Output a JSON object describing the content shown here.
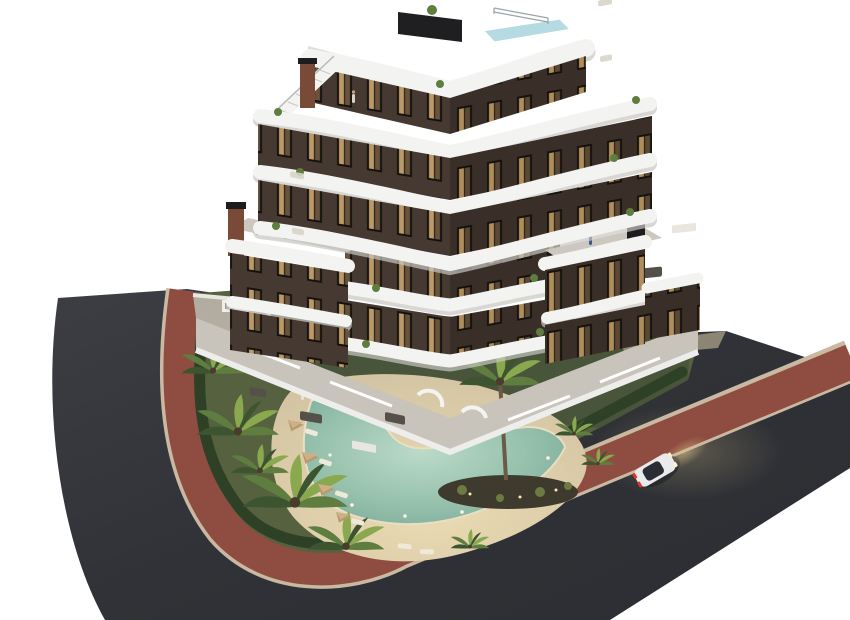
{
  "scene": {
    "type": "architectural-3d-render",
    "description": "Aerial dusk rendering of a modern stepped apartment building with curved white balcony bands, landscaped garden with free-form pool, corner plot wrapped by asphalt roads, red pedestrian sidewalk, and a white car driving on the right road",
    "background": "#ffffff",
    "colors": {
      "asphalt_light": "#3d3e44",
      "asphalt_dark": "#2b2d32",
      "sidewalk_red": "#8e4d40",
      "curb_tan": "#c9b9a2",
      "lawn": "#55613f",
      "lawn_shadow": "#46523a",
      "hedge": "#2e4026",
      "sand": "#dbcdad",
      "pool_edge": "#e8dec2",
      "pool_deep": "#7fae9c",
      "pool_light": "#bcdac9",
      "facade_brown": "#453931",
      "facade_brown_dark": "#3a2f28",
      "band_white": "#f3f3f1",
      "band_shadow": "#c7c6c2",
      "terrace_gray": "#c9c4bb",
      "roofpool_blue": "#b5dae2",
      "chimney_dark": "#1d1d1f",
      "chimney_brick": "#7a4a38",
      "palm_green": "#5f7d3f",
      "palm_light": "#8aa94f",
      "palm_dark": "#3c5530",
      "trunk_brown": "#6b5a45",
      "car_white": "#e9eaec",
      "car_glass": "#2a2d33",
      "taillight_red": "#e03524",
      "headlight_glow": "#d8c08a",
      "window_lit": "#d8b078",
      "window_frame": "#15120e"
    },
    "building": {
      "style": "stepped ziggurat, dark brown facade, white wavy balcony bands",
      "floors_visible": 7,
      "rooftop": [
        "plunge pool",
        "dark privacy screen",
        "metal railing",
        "staircase with white parapet",
        "brick chimney",
        "planter"
      ],
      "wings": [
        "left roof terrace with people and lounge set",
        "right roof terrace with lounge set"
      ],
      "chimneys": 3,
      "lit_windows": true
    },
    "garden": {
      "pool_shape": "free-form boomerang",
      "pool_lights": 5,
      "parasols": 4,
      "sun_loungers": 8,
      "palms": 9,
      "central_palm_island": true,
      "hedge_perimeter": true,
      "white_boundary_wall": true
    },
    "roads": {
      "count": 2,
      "surface": "dark asphalt",
      "sidewalk": "red pigmented walkway with light curbs wrapping the corner plot"
    },
    "car": {
      "color": "white",
      "taillights_on": true,
      "headlights_on": true,
      "heading": "up the right road"
    },
    "people_visible": 8,
    "time_of_day": "dusk, warm interior lights on"
  }
}
